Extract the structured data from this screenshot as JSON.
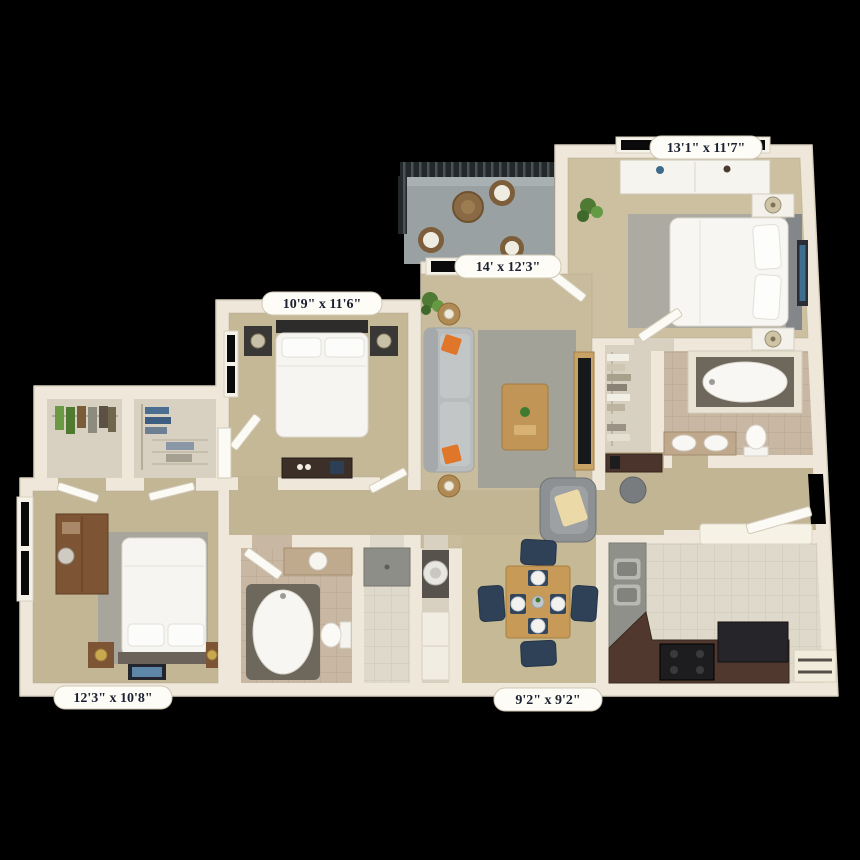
{
  "scene": {
    "type": "3d-apartment-floorplan-render",
    "background_color": "#000000"
  },
  "rooms": [
    {
      "id": "master-bedroom",
      "dimensions": "13'1\" x 11'7\""
    },
    {
      "id": "living-room",
      "dimensions": "14' x 12'3\""
    },
    {
      "id": "bedroom-2",
      "dimensions": "10'9\" x 11'6\""
    },
    {
      "id": "bedroom-3",
      "dimensions": "12'3\" x 10'8\""
    },
    {
      "id": "kitchen",
      "dimensions": "9'2\" x 9'2\""
    }
  ],
  "palette": {
    "wall": "#efe8da",
    "wall_edge": "#d9d1bf",
    "carpet": "#c9bc9c",
    "kitchen_tile": "#ded9cb",
    "bath_tile": "#c8b7a2",
    "rug_gray": "#9e9e99",
    "counter_brown": "#50382e",
    "counter_gray": "#90908a",
    "appliance_black": "#1d1d1f",
    "dining_chair_navy": "#2f4157",
    "accent_orange": "#e0762a",
    "wood": "#c89a58",
    "balcony_floor": "#9aa1a3",
    "railing_dark": "#23282b",
    "label_bg": "#fdfcf7",
    "label_text": "#1b2130"
  }
}
